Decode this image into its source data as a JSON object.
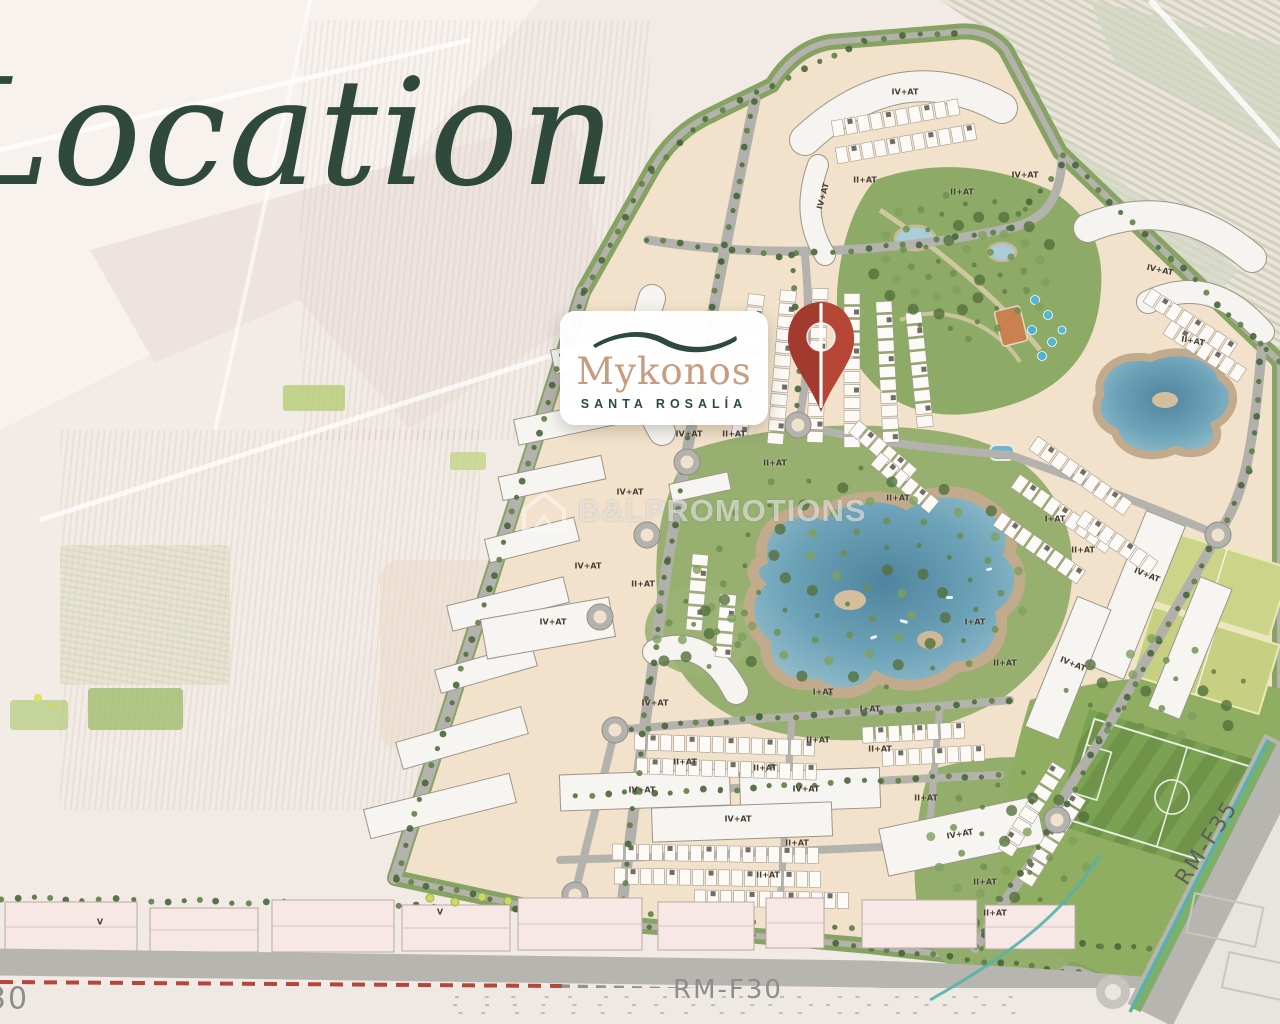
{
  "page_title": "Location",
  "logo_card": {
    "brand": "Mykonos",
    "subtitle": "SANTA ROSALÍA"
  },
  "watermark": {
    "text": "B&LPROMOTIONS"
  },
  "colors": {
    "title_green": "#2f4a3d",
    "brand_green": "#2e4a3f",
    "brand_tan": "#c79d82",
    "pin_red": "#a23a2d",
    "pin_red_light": "#b64736",
    "road_label_gray": "#8d8d8b",
    "site_beige": "#f3e2cb",
    "lake_blue": "#6398b0",
    "park_green": "#93ad6f"
  },
  "road_labels": [
    {
      "text": "RM-F30",
      "x": 728,
      "y": 990,
      "size": 26,
      "color": "#8d8d8b",
      "rot": 0
    },
    {
      "text": "30",
      "x": 8,
      "y": 999,
      "size": 30,
      "color": "#8d8d8b",
      "rot": 0
    },
    {
      "text": "RM-F35",
      "x": 1207,
      "y": 843,
      "size": 22,
      "color": "#5e5e5c",
      "rot": -57
    }
  ],
  "building_labels": [
    {
      "text": "IV+AT",
      "x": 905,
      "y": 92
    },
    {
      "text": "II+AT",
      "x": 865,
      "y": 180
    },
    {
      "text": "IV+AT",
      "x": 823,
      "y": 196,
      "rot": -75
    },
    {
      "text": "II+AT",
      "x": 962,
      "y": 192
    },
    {
      "text": "IV+AT",
      "x": 1025,
      "y": 175
    },
    {
      "text": "IV+AT",
      "x": 1160,
      "y": 270,
      "rot": 12
    },
    {
      "text": "II+AT",
      "x": 1193,
      "y": 341,
      "rot": 10
    },
    {
      "text": "IV+AT",
      "x": 689,
      "y": 434
    },
    {
      "text": "II+AT",
      "x": 734,
      "y": 434
    },
    {
      "text": "II+AT",
      "x": 775,
      "y": 463
    },
    {
      "text": "IV+AT",
      "x": 630,
      "y": 492
    },
    {
      "text": "II+AT",
      "x": 898,
      "y": 498
    },
    {
      "text": "I+AT",
      "x": 1055,
      "y": 519
    },
    {
      "text": "II+AT",
      "x": 1083,
      "y": 550
    },
    {
      "text": "IV+AT",
      "x": 588,
      "y": 566
    },
    {
      "text": "IV+AT",
      "x": 1147,
      "y": 575,
      "rot": 22
    },
    {
      "text": "II+AT",
      "x": 643,
      "y": 584
    },
    {
      "text": "IV+AT",
      "x": 553,
      "y": 622
    },
    {
      "text": "I+AT",
      "x": 975,
      "y": 622
    },
    {
      "text": "II+AT",
      "x": 1005,
      "y": 663
    },
    {
      "text": "IV+AT",
      "x": 1073,
      "y": 664,
      "rot": 22
    },
    {
      "text": "I+AT",
      "x": 823,
      "y": 692
    },
    {
      "text": "IV+AT",
      "x": 655,
      "y": 703
    },
    {
      "text": "I+AT",
      "x": 870,
      "y": 709
    },
    {
      "text": "II+AT",
      "x": 818,
      "y": 740
    },
    {
      "text": "II+AT",
      "x": 880,
      "y": 749
    },
    {
      "text": "II+AT",
      "x": 685,
      "y": 762
    },
    {
      "text": "II+AT",
      "x": 765,
      "y": 768
    },
    {
      "text": "IV+AT",
      "x": 642,
      "y": 790
    },
    {
      "text": "IV+AT",
      "x": 806,
      "y": 789
    },
    {
      "text": "II+AT",
      "x": 926,
      "y": 798
    },
    {
      "text": "IV+AT",
      "x": 738,
      "y": 819
    },
    {
      "text": "IV+AT",
      "x": 960,
      "y": 834,
      "rot": -10
    },
    {
      "text": "II+AT",
      "x": 797,
      "y": 843
    },
    {
      "text": "II+AT",
      "x": 768,
      "y": 875
    },
    {
      "text": "II+AT",
      "x": 985,
      "y": 882
    },
    {
      "text": "II+AT",
      "x": 995,
      "y": 913
    },
    {
      "text": "V",
      "x": 100,
      "y": 922
    },
    {
      "text": "V",
      "x": 440,
      "y": 912
    }
  ]
}
